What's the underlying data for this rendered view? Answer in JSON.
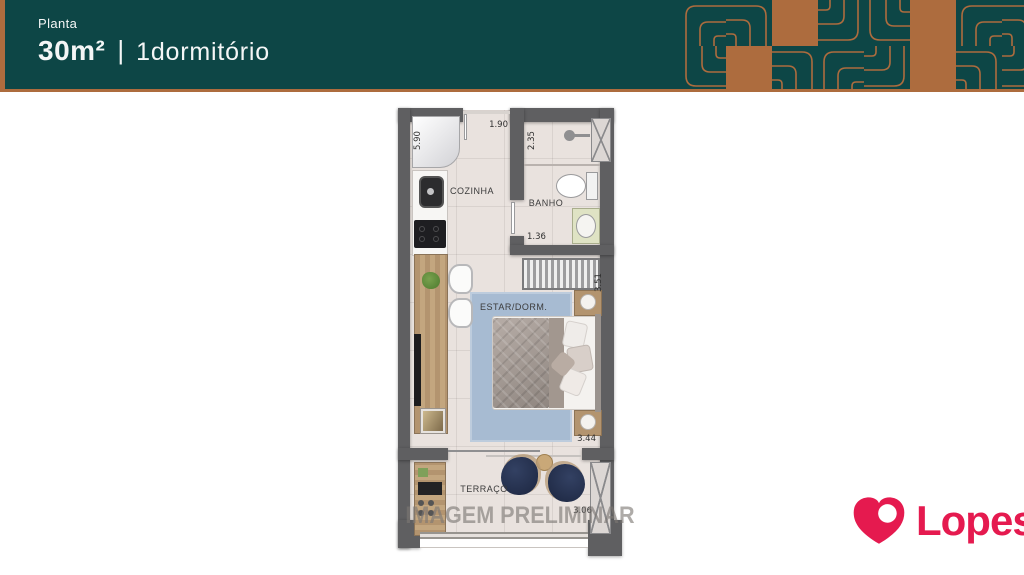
{
  "colors": {
    "teal": "#0d4646",
    "copper": "#ad6c3e",
    "header_text": "#f4f6f6",
    "logo_pink": "#e51a4f",
    "wall": "#5f5f61",
    "floor": "#e9e2de",
    "rug": "#a7bbd2",
    "wood": "#b3946f",
    "navy": "#273452",
    "watermark": "#7d7874"
  },
  "header": {
    "eyebrow": "Planta",
    "area": "30m²",
    "separator": "|",
    "unit": "1dormitório"
  },
  "floorplan": {
    "watermark": "IMAGEM PRELIMINAR",
    "rooms": {
      "kitchen": "COZINHA",
      "bath": "BANHO",
      "living": "ESTAR/DORM.",
      "terrace": "TERRAÇO"
    },
    "dimensions": {
      "unit_length": "5.90",
      "kitchen_width": "1.90",
      "shower_depth": "2.35",
      "bath_width": "1.36",
      "wardrobe_span": "3.51",
      "living_width": "3.44",
      "terrace_width": "3.06"
    }
  },
  "logo": {
    "text": "Lopes"
  }
}
